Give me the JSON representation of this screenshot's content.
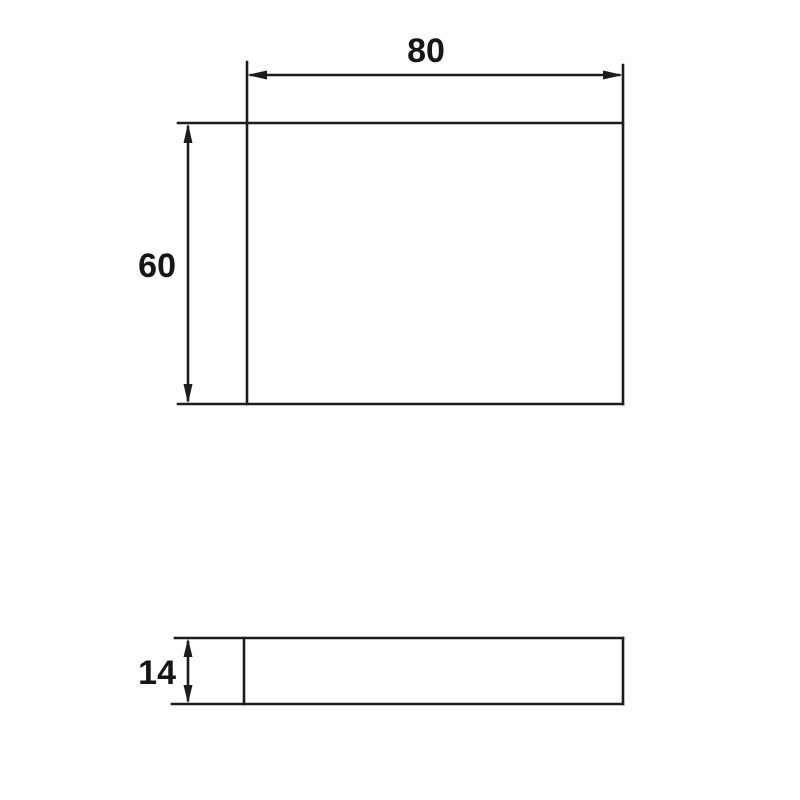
{
  "drawing": {
    "background_color": "#ffffff",
    "line_color": "#1c1c1c",
    "text_color": "#161616",
    "views": [
      {
        "id": "plan-view",
        "shape": "rectangle",
        "dimensions": [
          {
            "axis": "horizontal",
            "value": "80"
          },
          {
            "axis": "vertical",
            "value": "60"
          }
        ]
      },
      {
        "id": "side-view",
        "shape": "thin-rectangle",
        "dimensions": [
          {
            "axis": "vertical",
            "value": "14"
          }
        ]
      }
    ]
  }
}
